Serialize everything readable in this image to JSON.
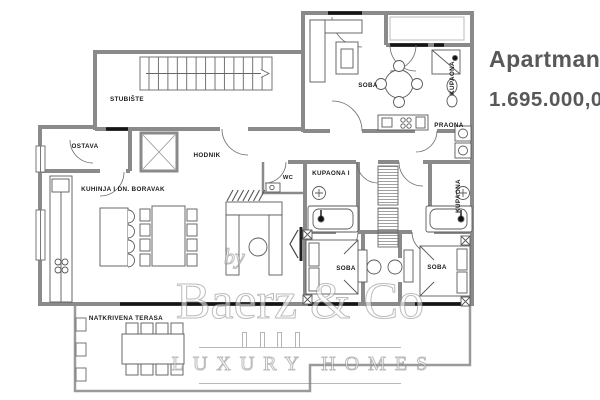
{
  "listing": {
    "title": "Apartman",
    "price": "1.695.000,00",
    "text_color": "#57585a"
  },
  "plan": {
    "wall_color": "#8a8a8a",
    "line_color": "#555555",
    "opening_color": "#151515",
    "rooms": {
      "stubiste": "STUBIŠTE",
      "ostava": "OSTAVA",
      "hodnik": "HODNIK",
      "kuhinja": "KUHINJA I DN. BORAVAK",
      "wc": "WC",
      "soba_top": "SOBA",
      "kupaona_top": "KUPAONA",
      "praona": "PRAONA",
      "kupaona_1": "KUPAONA I",
      "kupaona_right": "KUPAONA",
      "soba_left": "SOBA",
      "soba_right": "SOBA",
      "terasa": "NATKRIVENA TERASA"
    }
  },
  "watermark": {
    "by": "by",
    "name": "Baerz & Co",
    "tagline": "LUXURY HOMES"
  }
}
